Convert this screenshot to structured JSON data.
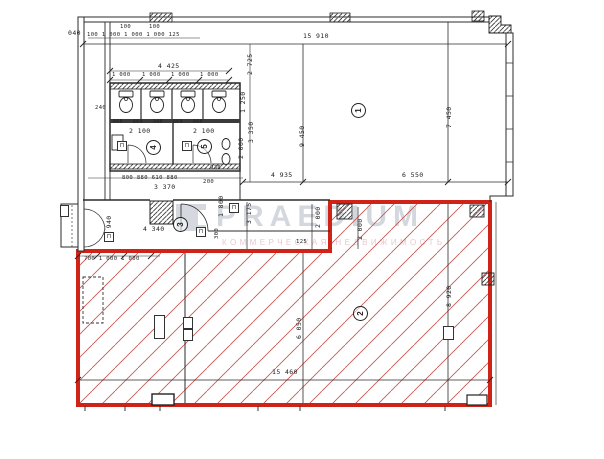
{
  "watermark": {
    "title": "PRAEDIUM",
    "subtitle": "КОММЕРЧЕСКАЯ НЕДВИЖИМОСТЬ"
  },
  "colors": {
    "red_outline": "#cf2318",
    "red_hatch": "#c4534e",
    "drawing_line": "#2b2b2b",
    "watermark_gray": "#b0b8c4",
    "watermark_pink": "#d49aa6"
  },
  "plan": {
    "rooms": [
      {
        "number": "1",
        "cx": 358,
        "cy": 110
      },
      {
        "number": "2",
        "cx": 360,
        "cy": 313
      },
      {
        "number": "3",
        "cx": 180,
        "cy": 224
      },
      {
        "number": "4",
        "cx": 153,
        "cy": 147
      },
      {
        "number": "5",
        "cx": 204,
        "cy": 146
      }
    ],
    "dimensions": [
      {
        "text": "040",
        "x": 68,
        "y": 30
      },
      {
        "text": "100",
        "x": 120,
        "y": 24,
        "fs": 5.5
      },
      {
        "text": "100",
        "x": 149,
        "y": 24,
        "fs": 5.5
      },
      {
        "text": "100 1 000 1 000 1 000 125",
        "x": 87,
        "y": 32,
        "fs": 5.5
      },
      {
        "text": "15 910",
        "x": 303,
        "y": 33
      },
      {
        "text": "4 425",
        "x": 158,
        "y": 63
      },
      {
        "text": "1 000",
        "x": 112,
        "y": 72,
        "fs": 5.5
      },
      {
        "text": "1 000",
        "x": 142,
        "y": 72,
        "fs": 5.5
      },
      {
        "text": "1 000",
        "x": 171,
        "y": 72,
        "fs": 5.5
      },
      {
        "text": "1 000",
        "x": 200,
        "y": 72,
        "fs": 5.5
      },
      {
        "text": "240",
        "x": 95,
        "y": 105,
        "fs": 5.5
      },
      {
        "text": "660",
        "x": 113,
        "y": 119,
        "fs": 4.8
      },
      {
        "text": "660",
        "x": 133,
        "y": 119,
        "fs": 4.8
      },
      {
        "text": "340",
        "x": 153,
        "y": 119,
        "fs": 4.8
      },
      {
        "text": "660",
        "x": 173,
        "y": 119,
        "fs": 4.8
      },
      {
        "text": "660",
        "x": 193,
        "y": 119,
        "fs": 4.8
      },
      {
        "text": "2 100",
        "x": 129,
        "y": 128
      },
      {
        "text": "2 100",
        "x": 193,
        "y": 128
      },
      {
        "text": "930",
        "x": 210,
        "y": 165,
        "fs": 5.5
      },
      {
        "text": "800 880 610 880",
        "x": 122,
        "y": 175,
        "fs": 5.5
      },
      {
        "text": "200",
        "x": 203,
        "y": 179,
        "fs": 5.5
      },
      {
        "text": "3 370",
        "x": 154,
        "y": 184
      },
      {
        "text": "4 340",
        "x": 143,
        "y": 226
      },
      {
        "text": "4 935",
        "x": 271,
        "y": 172
      },
      {
        "text": "6 550",
        "x": 402,
        "y": 172
      },
      {
        "text": "700 1 000 1 000",
        "x": 84,
        "y": 256,
        "fs": 5.5
      },
      {
        "text": "15 460",
        "x": 272,
        "y": 369
      },
      {
        "text": "125",
        "x": 296,
        "y": 239,
        "fs": 5.5
      },
      {
        "text": "1 250",
        "x": 240,
        "y": 113,
        "v": 1
      },
      {
        "text": "2 000",
        "x": 238,
        "y": 159,
        "v": 1
      },
      {
        "text": "2 725",
        "x": 247,
        "y": 75,
        "v": 1
      },
      {
        "text": "3 350",
        "x": 248,
        "y": 143,
        "v": 1
      },
      {
        "text": "9 450",
        "x": 299,
        "y": 147,
        "v": 1
      },
      {
        "text": "7 450",
        "x": 446,
        "y": 128,
        "v": 1
      },
      {
        "text": "1 940",
        "x": 106,
        "y": 237,
        "v": 1
      },
      {
        "text": "1 800",
        "x": 218,
        "y": 217,
        "v": 1
      },
      {
        "text": "300",
        "x": 214,
        "y": 239,
        "v": 1,
        "fs": 5.5
      },
      {
        "text": "3 175",
        "x": 246,
        "y": 224,
        "v": 1
      },
      {
        "text": "2 000",
        "x": 315,
        "y": 228,
        "v": 1
      },
      {
        "text": "2 000",
        "x": 357,
        "y": 240,
        "v": 1
      },
      {
        "text": "6 050",
        "x": 296,
        "y": 339,
        "v": 1
      },
      {
        "text": "8 920",
        "x": 446,
        "y": 307,
        "v": 1
      }
    ],
    "tags": [
      {
        "text": "П",
        "x": 117,
        "y": 141,
        "w": 8,
        "h": 8
      },
      {
        "text": "П",
        "x": 182,
        "y": 141,
        "w": 8,
        "h": 8
      },
      {
        "text": "П",
        "x": 229,
        "y": 203,
        "w": 8,
        "h": 8
      },
      {
        "text": "П",
        "x": 196,
        "y": 227,
        "w": 8,
        "h": 8
      },
      {
        "text": "П",
        "x": 104,
        "y": 232,
        "w": 8,
        "h": 8
      },
      {
        "text": "",
        "x": 60,
        "y": 205,
        "w": 7,
        "h": 10
      },
      {
        "text": "",
        "x": 154,
        "y": 315,
        "w": 9,
        "h": 22
      },
      {
        "text": "",
        "x": 183,
        "y": 317,
        "w": 8,
        "h": 10
      },
      {
        "text": "",
        "x": 183,
        "y": 329,
        "w": 8,
        "h": 10
      },
      {
        "text": "",
        "x": 443,
        "y": 326,
        "w": 9,
        "h": 12
      }
    ]
  }
}
